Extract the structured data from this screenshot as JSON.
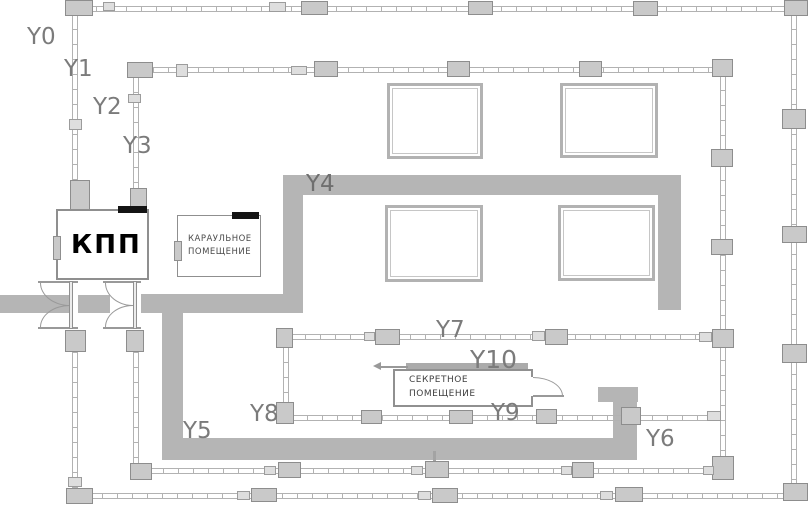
{
  "labels": {
    "y0": "Y0",
    "y1": "Y1",
    "y2": "Y2",
    "y3": "Y3",
    "y4": "Y4",
    "y5": "Y5",
    "y6": "Y6",
    "y7": "Y7",
    "y8": "Y8",
    "y9": "Y9",
    "y10": "Y10"
  },
  "buildings": {
    "checkpoint": {
      "name": "КПП"
    },
    "guard_room": {
      "name_line1": "КАРАУЛЬНОЕ",
      "name_line2": "ПОМЕЩЕНИЕ"
    },
    "secret_room": {
      "name_line1": "СЕКРЕТНОЕ",
      "name_line2": "ПОМЕЩЕНИЕ"
    }
  },
  "colors": {
    "path_gray": "#b5b5b5",
    "fence_gray": "#b2b2b2",
    "post_fill": "#c9c9c9",
    "post_border": "#8d8d8d",
    "label_gray": "#7b7b7b",
    "marker_black": "#141414"
  }
}
